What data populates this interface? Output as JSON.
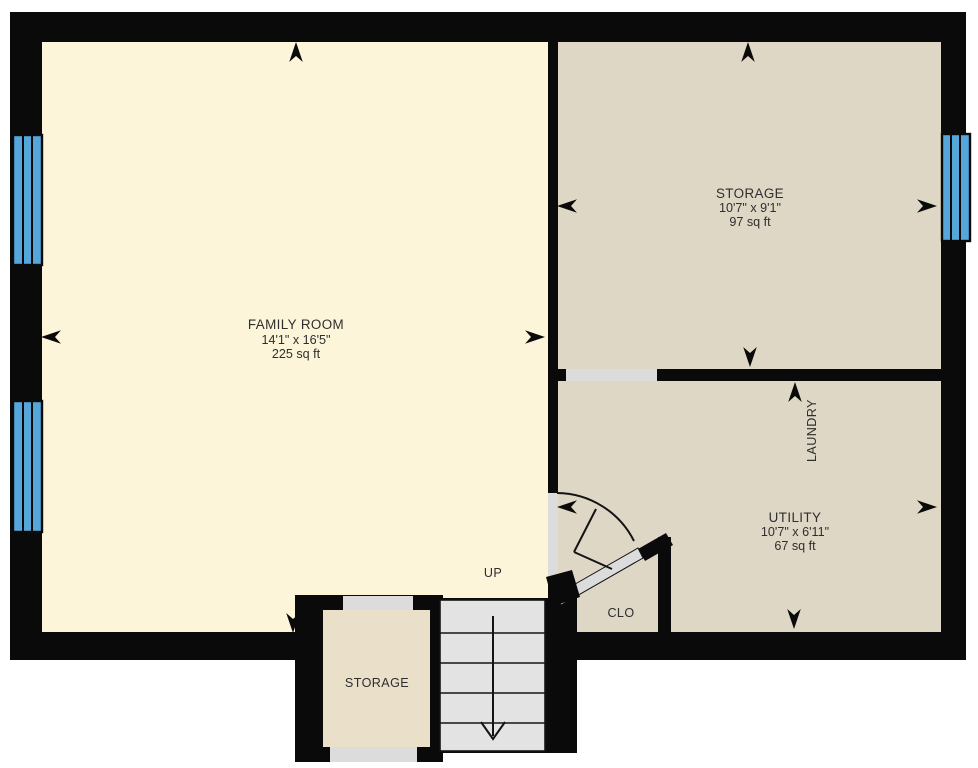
{
  "rooms": {
    "family": {
      "name": "FAMILY ROOM",
      "dimensions": "14'1\" x 16'5\"",
      "area": "225 sq ft"
    },
    "storage": {
      "name": "STORAGE",
      "dimensions": "10'7\" x 9'1\"",
      "area": "97 sq ft"
    },
    "utility": {
      "name": "UTILITY",
      "dimensions": "10'7\" x 6'11\"",
      "area": "67 sq ft"
    },
    "laundry": {
      "label": "LAUNDRY"
    },
    "closet": {
      "label": "CLO"
    },
    "storage_small": {
      "label": "STORAGE"
    }
  },
  "stairs": {
    "label": "UP"
  },
  "colors": {
    "wall": "#0a0a0a",
    "family_room_floor": "#fcf5d9",
    "storage_utility_floor": "#dfd7c5",
    "small_storage_floor": "#eae0ca",
    "stairs_fill": "#e3e3e3",
    "door_opening_fill": "#dcdcdc",
    "window_fill": "#55a7db",
    "background": "#ffffff",
    "label_text": "#2e2e2e"
  }
}
